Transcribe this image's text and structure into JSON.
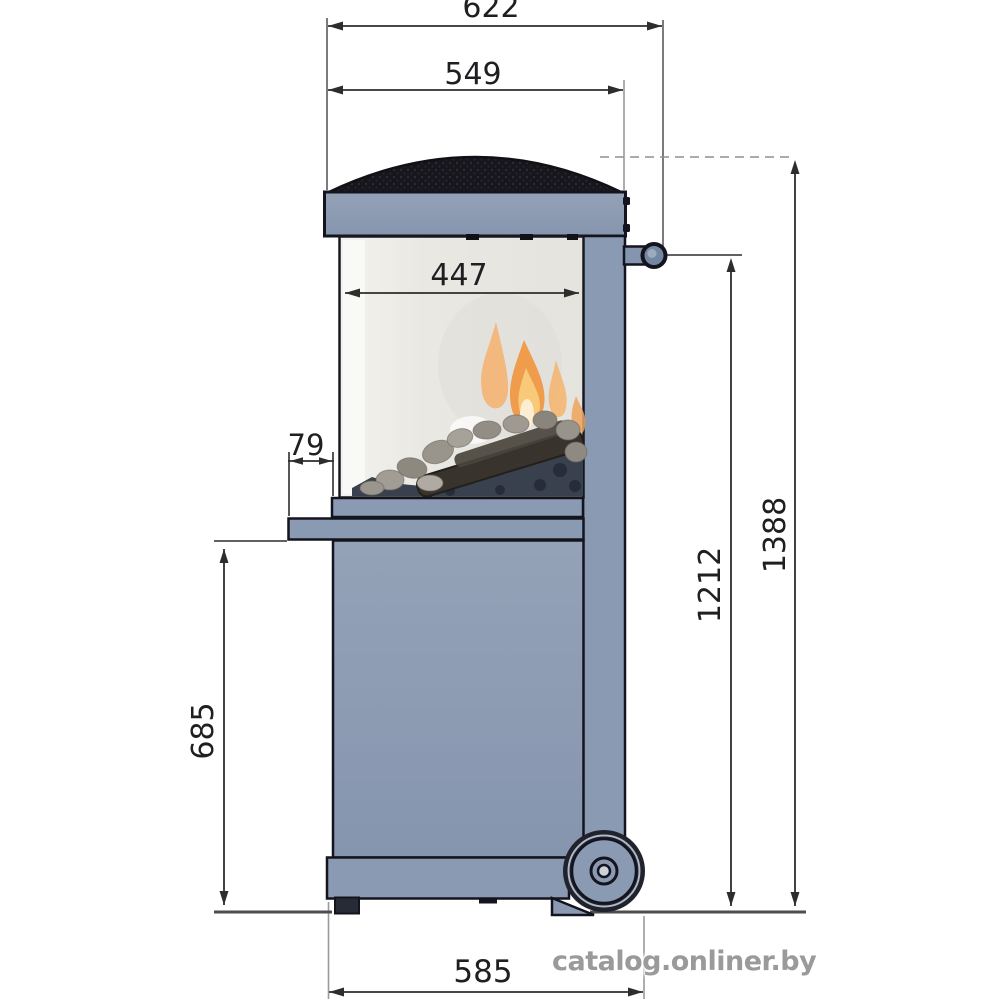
{
  "page": {
    "background": "#ffffff"
  },
  "drawing": {
    "type": "technical-dimension-drawing",
    "subject": "outdoor gas fireplace, side elevation with dimensions",
    "unit": "mm",
    "dimensions": {
      "overall_width_top": "622",
      "cap_width": "549",
      "glass_width": "447",
      "shelf_overhang": "79",
      "under_shelf_height": "685",
      "handle_height": "1212",
      "overall_height": "1388",
      "base_width": "585"
    },
    "colors": {
      "body_blue_gray": "#8b9ab3",
      "outline": "#14141f",
      "dome_grill": "#17171d",
      "glass": "#edebe6",
      "flame_orange": "#ef9c4c",
      "flame_yellow": "#f8c979",
      "dimension_line": "#2d2d2d",
      "ground_line": "#4d4d4d"
    }
  },
  "watermark": {
    "text": "catalog.onliner.by",
    "color": "#9a9a9a"
  }
}
